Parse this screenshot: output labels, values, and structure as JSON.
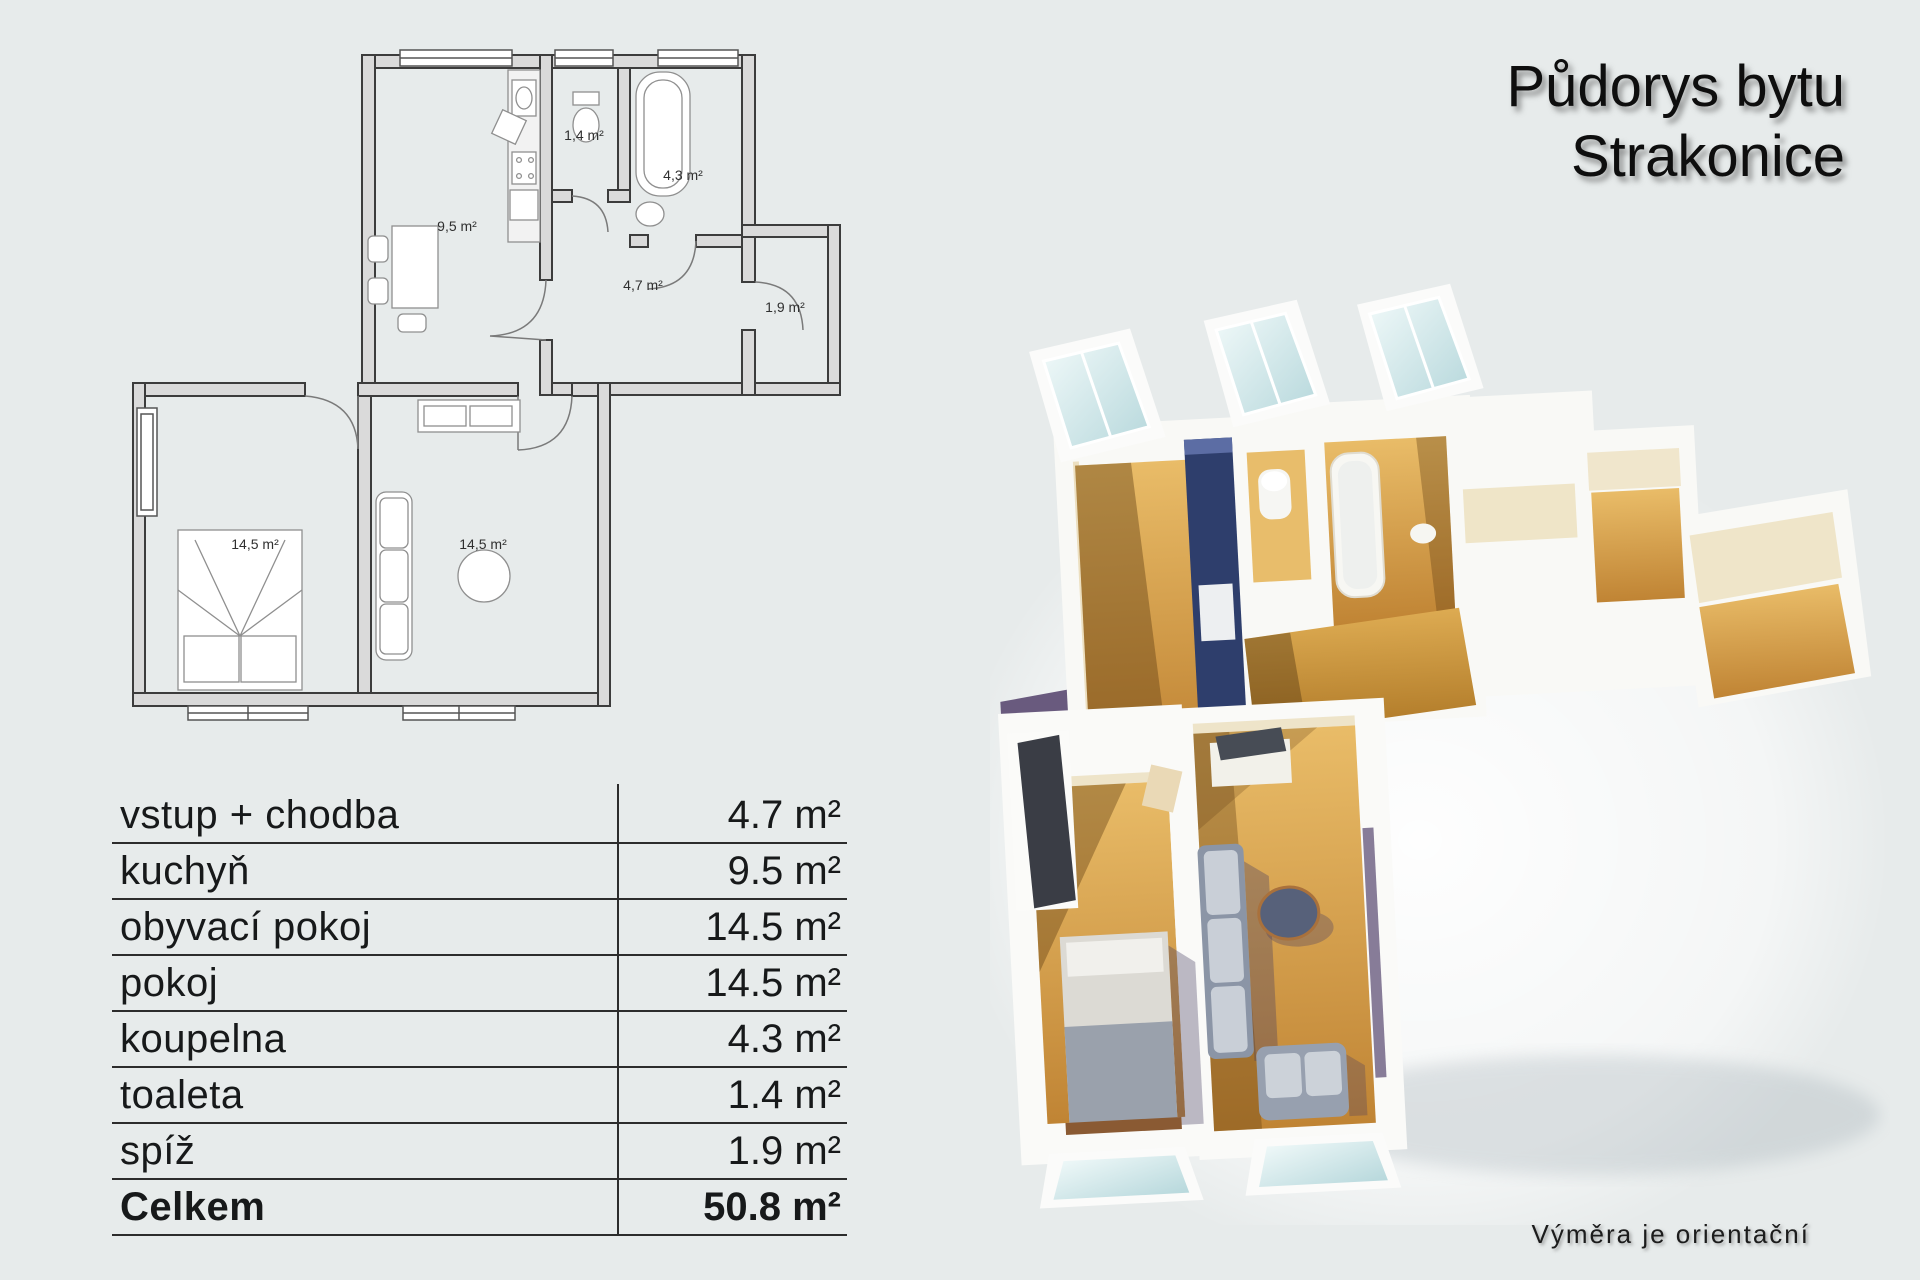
{
  "title": {
    "line1": "Půdorys bytu",
    "line2": "Strakonice"
  },
  "table": {
    "rows": [
      {
        "label": "vstup + chodba",
        "value": "4.7 m²"
      },
      {
        "label": "kuchyň",
        "value": "9.5 m²"
      },
      {
        "label": "obyvací pokoj",
        "value": "14.5 m²"
      },
      {
        "label": "pokoj",
        "value": "14.5 m²"
      },
      {
        "label": "koupelna",
        "value": "4.3 m²"
      },
      {
        "label": "toaleta",
        "value": "1.4 m²"
      },
      {
        "label": "spíž",
        "value": "1.9 m²"
      }
    ],
    "total": {
      "label": "Celkem",
      "value": "50.8 m²"
    }
  },
  "floorplan_2d": {
    "room_labels": [
      {
        "room": "kuchyň",
        "text": "9,5 m²"
      },
      {
        "room": "toaleta",
        "text": "1,4 m²"
      },
      {
        "room": "koupelna",
        "text": "4,3 m²"
      },
      {
        "room": "vstup-chodba",
        "text": "4,7 m²"
      },
      {
        "room": "spíž",
        "text": "1,9 m²"
      },
      {
        "room": "pokoj",
        "text": "14,5 m²"
      },
      {
        "room": "obyvací pokoj",
        "text": "14,5 m²"
      }
    ]
  },
  "footer": {
    "note": "Výměra je orientační"
  },
  "colors": {
    "background": "#e7ebeb",
    "text": "#17191a",
    "plan_wall_gray": "#dadada",
    "wood_floor": "#d9a851",
    "kitchen_cabinet_blue": "#2e3e6c",
    "shadow_purple": "#6a5c80",
    "wall_white": "#f9f9f6",
    "glass_blue": "#cfe4e6"
  }
}
